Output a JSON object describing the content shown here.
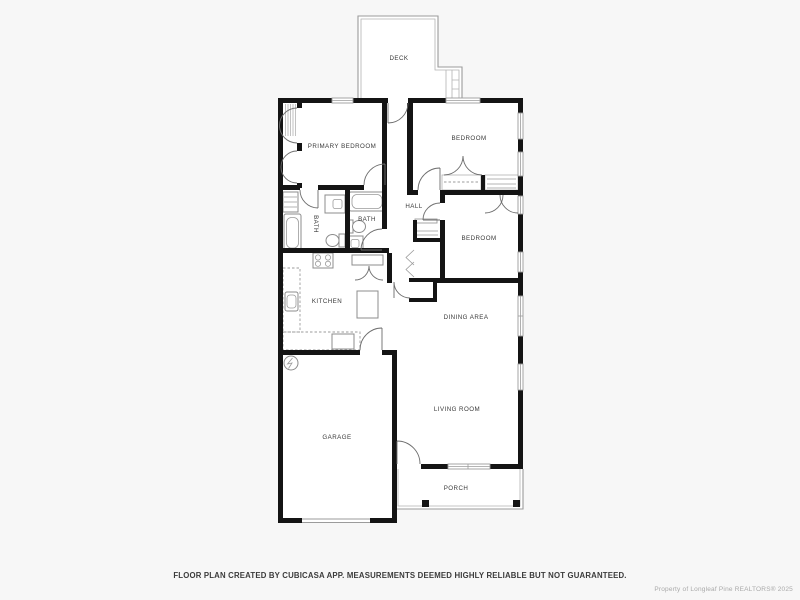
{
  "colors": {
    "background": "#f7f7f7",
    "walls": "#141414",
    "thin_lines": "#9b9b9b",
    "room_labels": "#3a3a3a",
    "disclaimer_text": "#3b3b3b",
    "watermark_text": "#a9a9a9"
  },
  "rooms": {
    "deck": {
      "label": "DECK"
    },
    "primary_bedroom": {
      "label": "PRIMARY BEDROOM"
    },
    "bedroom_top_right": {
      "label": "BEDROOM"
    },
    "primary_bath": {
      "label": "BATH"
    },
    "hall_bath": {
      "label": "BATH"
    },
    "hall": {
      "label": "HALL"
    },
    "bedroom_middle_right": {
      "label": "BEDROOM"
    },
    "kitchen": {
      "label": "KITCHEN"
    },
    "dining_area": {
      "label": "DINING AREA"
    },
    "living_room": {
      "label": "LIVING ROOM"
    },
    "garage": {
      "label": "GARAGE"
    },
    "porch": {
      "label": "PORCH"
    }
  },
  "fixtures": {
    "water_heater": "circle-with-element-coil",
    "bathtubs": "rounded-rect-tub",
    "toilets": "tank-and-bowl",
    "sinks": "counter-with-basin",
    "stove": "four-burner-cooktop",
    "kitchen_island": "plain-rect",
    "closets": "shelf-lines-and-bifold-door-arcs",
    "windows": "double-line-wall-gap",
    "doors": "quarter-circle-swing-arc"
  },
  "footer": {
    "disclaimer": "FLOOR PLAN CREATED BY CUBICASA APP. MEASUREMENTS DEEMED HIGHLY RELIABLE BUT NOT GUARANTEED."
  },
  "watermark": {
    "text": "Property of Longleaf Pine REALTORS®  2025"
  }
}
